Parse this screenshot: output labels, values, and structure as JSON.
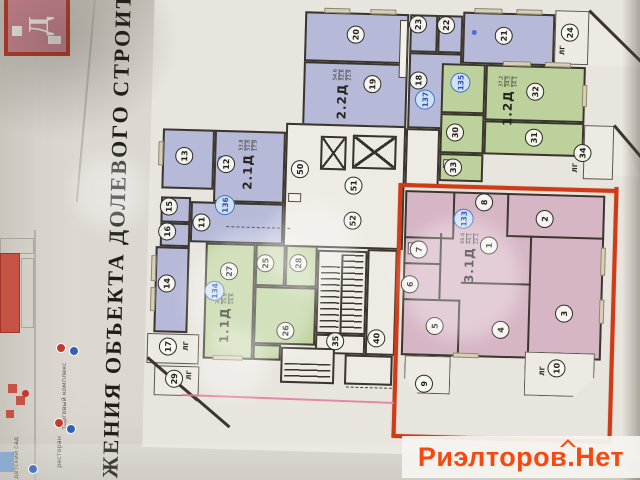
{
  "document": {
    "vertical_title": "ЖЕНИЯ ОБЪЕКТА ДОЛЕВОГО СТРОИТЕЛ",
    "building_marker": "Д"
  },
  "watermark": {
    "text": "Риэлторов.Нет",
    "color": "#fa470e"
  },
  "site_plan": {
    "legend": [
      {
        "label": "торговый комплекс"
      },
      {
        "label": "ресторан"
      },
      {
        "label": "детский сад"
      }
    ]
  },
  "floor_plan": {
    "loggia_abbr": "ЛГ",
    "apartments": [
      {
        "type_label": "2.2Д",
        "unit_number": "137",
        "color": "#b6bad8",
        "areas": [
          "54.6",
          "52.6",
          "21.9"
        ]
      },
      {
        "type_label": "1.2Д",
        "unit_number": "135",
        "color": "#bdd19c",
        "areas": [
          "37.2",
          "34.5",
          "14.1"
        ]
      },
      {
        "type_label": "2.1Д",
        "unit_number": "136",
        "color": "#b6bad8",
        "areas": [
          "53.8",
          "51.6",
          "17.9"
        ]
      },
      {
        "type_label": "1.1Д",
        "unit_number": "134",
        "color": "#bdd19c",
        "areas": [
          "38.2",
          "35.9",
          "14.6"
        ]
      },
      {
        "type_label": "3.1Д",
        "unit_number": "133",
        "color": "#d6b5c5",
        "highlighted": true,
        "areas": [
          "66.6",
          "44.1",
          "22.1"
        ]
      }
    ],
    "room_circles": [
      {
        "n": "20",
        "x": 350,
        "y": 36
      },
      {
        "n": "19",
        "x": 368,
        "y": 85
      },
      {
        "n": "23",
        "x": 412,
        "y": 24
      },
      {
        "n": "22",
        "x": 440,
        "y": 24
      },
      {
        "n": "18",
        "x": 414,
        "y": 80
      },
      {
        "n": "21",
        "x": 498,
        "y": 33
      },
      {
        "n": "24",
        "x": 564,
        "y": 28
      },
      {
        "n": "32",
        "x": 531,
        "y": 88
      },
      {
        "n": "31",
        "x": 531,
        "y": 134
      },
      {
        "n": "30",
        "x": 452,
        "y": 131
      },
      {
        "n": "33",
        "x": 451,
        "y": 166
      },
      {
        "n": "34",
        "x": 580,
        "y": 148
      },
      {
        "n": "13",
        "x": 182,
        "y": 162
      },
      {
        "n": "12",
        "x": 224,
        "y": 169
      },
      {
        "n": "15",
        "x": 168,
        "y": 213
      },
      {
        "n": "16",
        "x": 167,
        "y": 238
      },
      {
        "n": "11",
        "x": 201,
        "y": 228
      },
      {
        "n": "14",
        "x": 168,
        "y": 290
      },
      {
        "n": "17",
        "x": 171,
        "y": 353
      },
      {
        "n": "29",
        "x": 178,
        "y": 385
      },
      {
        "n": "27",
        "x": 230,
        "y": 276
      },
      {
        "n": "25",
        "x": 266,
        "y": 267
      },
      {
        "n": "28",
        "x": 299,
        "y": 266
      },
      {
        "n": "26",
        "x": 288,
        "y": 334
      },
      {
        "n": "50",
        "x": 298,
        "y": 172
      },
      {
        "n": "51",
        "x": 352,
        "y": 187
      },
      {
        "n": "52",
        "x": 352,
        "y": 222
      },
      {
        "n": "35",
        "x": 338,
        "y": 343
      },
      {
        "n": "40",
        "x": 379,
        "y": 339
      },
      {
        "n": "8",
        "x": 483,
        "y": 200
      },
      {
        "n": "2",
        "x": 544,
        "y": 215
      },
      {
        "n": "1",
        "x": 489,
        "y": 243
      },
      {
        "n": "7",
        "x": 419,
        "y": 249
      },
      {
        "n": "6",
        "x": 411,
        "y": 284
      },
      {
        "n": "5",
        "x": 437,
        "y": 325
      },
      {
        "n": "4",
        "x": 503,
        "y": 327
      },
      {
        "n": "3",
        "x": 566,
        "y": 309
      },
      {
        "n": "9",
        "x": 428,
        "y": 383
      },
      {
        "n": "10",
        "x": 560,
        "y": 364
      }
    ],
    "unit_badges": [
      {
        "n": "137",
        "x": 421,
        "y": 99
      },
      {
        "n": "135",
        "x": 456,
        "y": 81
      },
      {
        "n": "136",
        "x": 224,
        "y": 210
      },
      {
        "n": "134",
        "x": 216,
        "y": 296
      },
      {
        "n": "133",
        "x": 463,
        "y": 217
      }
    ],
    "loggia_labels": [
      {
        "t": "ЛГ",
        "x": 557,
        "y": 46
      },
      {
        "t": "ЛГ",
        "x": 573,
        "y": 163
      },
      {
        "t": "ЛГ",
        "x": 189,
        "y": 352
      },
      {
        "t": "ЛГ",
        "x": 193,
        "y": 381
      },
      {
        "t": "ЛГ",
        "x": 546,
        "y": 367
      }
    ]
  }
}
